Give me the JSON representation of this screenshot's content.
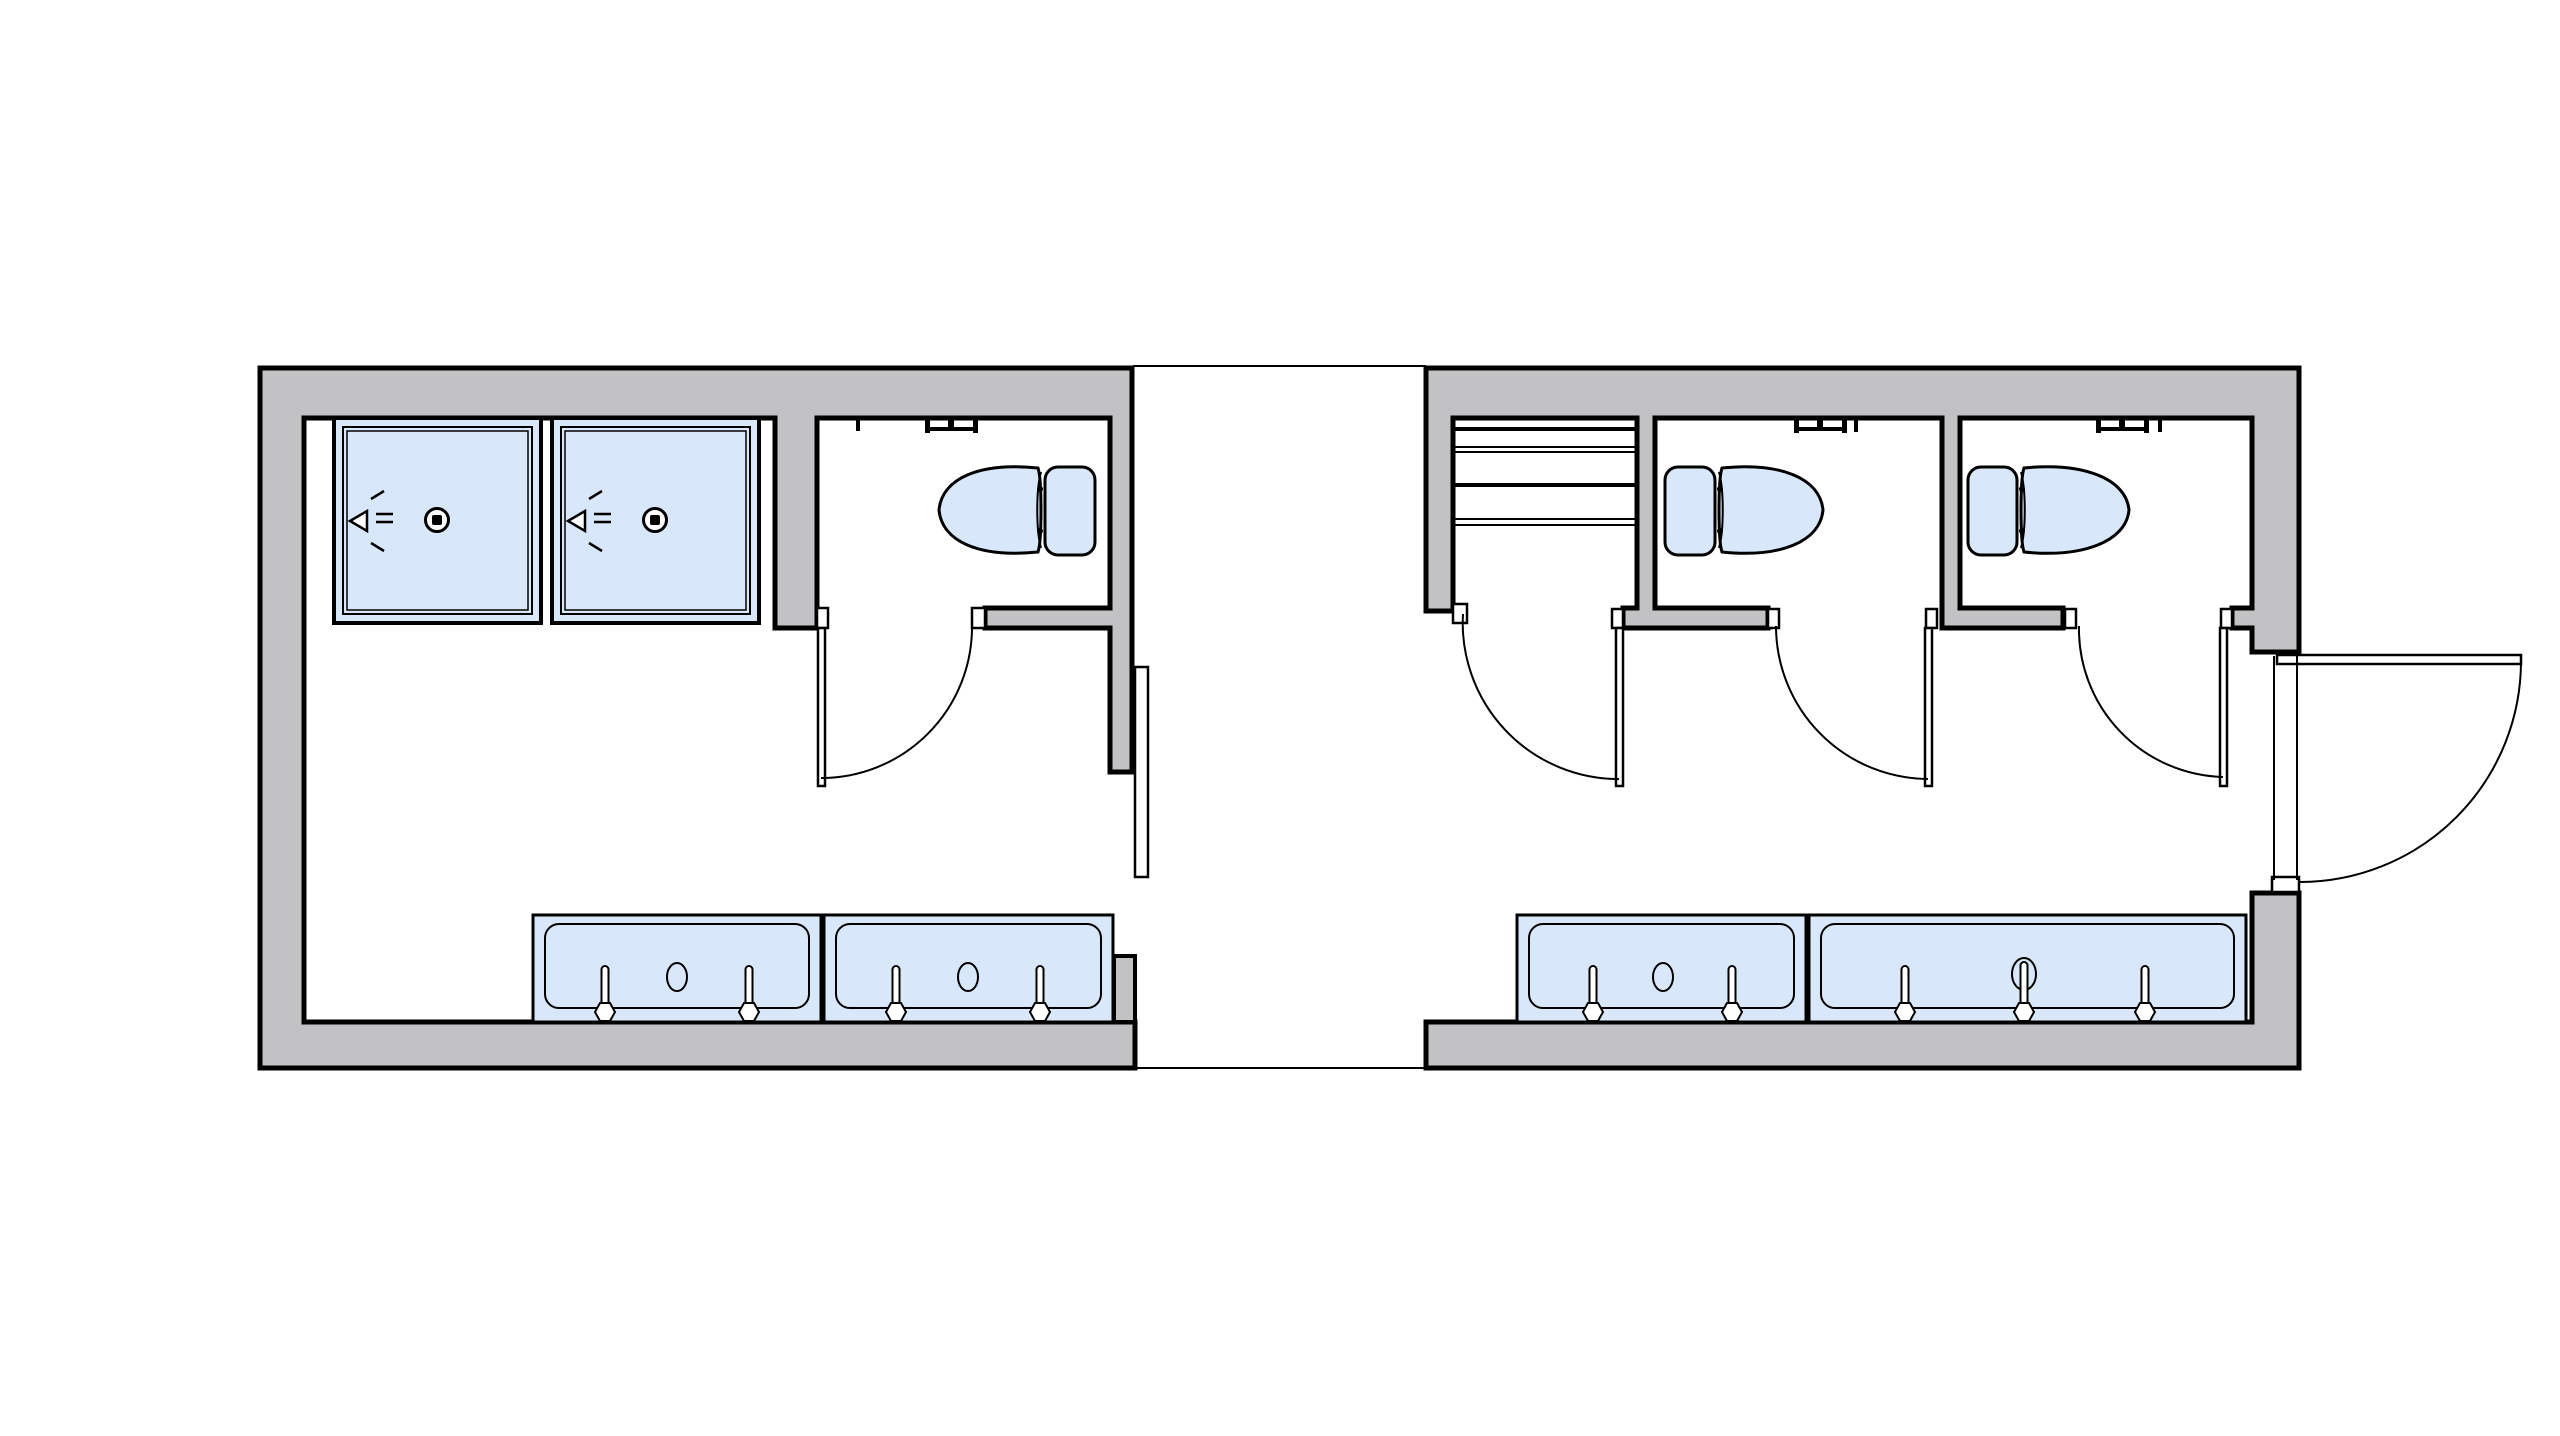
{
  "colors": {
    "background": "#ffffff",
    "wall_fill": "#c2c2c4",
    "outline": "#000000",
    "fixture_fill": "#d8e7f9",
    "white_fill": "#ffffff"
  },
  "plan": {
    "type": "bathhouse-floor-plan",
    "buildings": [
      {
        "name": "left-building",
        "rooms": [
          "shower-area",
          "toilet-room"
        ],
        "fixtures": {
          "shower_stalls": 2,
          "shower_drains": 2,
          "showerheads": 2,
          "toilets": 1,
          "toilet_paper_dispensers": 1,
          "sink_units": 2,
          "faucets": 4,
          "sink_drains": 2,
          "swing_doors": 1,
          "sliding_leaves": 1
        }
      },
      {
        "name": "right-building",
        "rooms": [
          "shelving-room",
          "toilet-room-1",
          "toilet-room-2"
        ],
        "fixtures": {
          "shelf_rows": 4,
          "toilets": 2,
          "toilet_paper_dispensers": 2,
          "sink_units": 2,
          "faucets": 5,
          "sink_drains": 2,
          "swing_doors": 4
        }
      }
    ],
    "connection": "open-breezeway-between-buildings"
  }
}
